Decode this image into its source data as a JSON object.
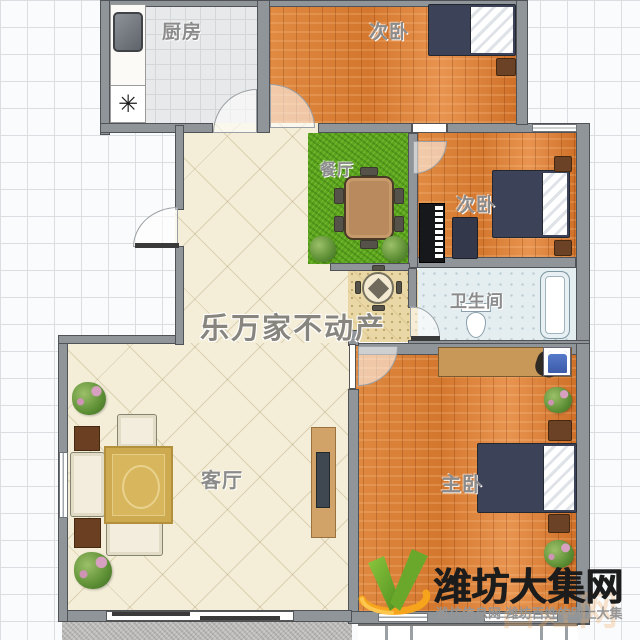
{
  "floorplan": {
    "watermark_agency": "乐万家不动产",
    "rooms": {
      "kitchen": {
        "label": "厨房",
        "stove_glyph": "✳"
      },
      "bedroom_top": {
        "label": "次卧"
      },
      "bedroom_mid": {
        "label": "次卧"
      },
      "dining": {
        "label": "餐厅"
      },
      "bathroom": {
        "label": "卫生间"
      },
      "living": {
        "label": "客厅"
      },
      "master": {
        "label": "主卧"
      }
    },
    "palette": {
      "wood_floor": "#dd8038",
      "grass_green": "#5ea61e",
      "tile_beige": "#f4eed8",
      "foyer_tan": "#e9d8a5",
      "bath_blue": "#e4edf0",
      "wall_gray": "#90959a",
      "bed_navy": "#3c4257",
      "rug_gold": "#d8b65e"
    }
  },
  "branding": {
    "site_name": "潍坊大集网",
    "tagline": "潍坊信息网 潍坊百姓的网上大集",
    "faint_watermark": "百姓网",
    "logo_icon": "green-v-orange-swoosh",
    "colors": {
      "logo_green": "#7ab82e",
      "logo_green_dark": "#4f8f1f",
      "logo_orange": "#f6a41c",
      "title_black": "#1c1c1c",
      "tagline_gray": "#969696"
    }
  }
}
